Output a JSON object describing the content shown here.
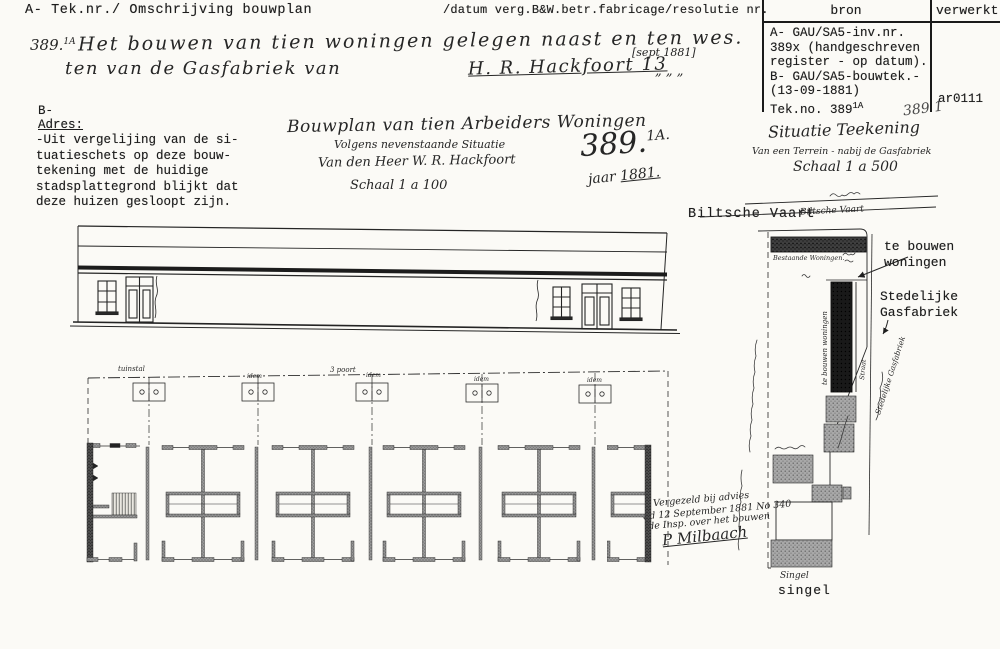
{
  "doc": {
    "header_left": "A- Tek.nr./ Omschrijving bouwplan",
    "header_center": "/datum verg.B&W.betr.fabricage/resolutie nr."
  },
  "bron_table": {
    "col_bron": "bron",
    "col_verwerkt": "verwerkt",
    "lines": [
      "A- GAU/SA5-inv.nr.",
      "389x (handgeschreven",
      "register - op datum).",
      "B- GAU/SA5-bouwtek.-",
      "(13-09-1881)"
    ],
    "tek_no": "Tek.no. 389",
    "tek_no_sup": "1A",
    "verwerkt_value": "ar0111",
    "pencil_note": "389 1"
  },
  "registration": {
    "number": "389.",
    "number_sup": "1A",
    "line1": "Het bouwen van tien woningen gelegen naast en ten wes.",
    "line2": "ten van de Gasfabriek van",
    "signature": "H. R. Hackfoort 13",
    "date_bracket": "[sept 1881]",
    "ditto_marks": "„    „    „"
  },
  "adres": {
    "b_label": "B-",
    "title": "Adres:",
    "lines": [
      "-Uit vergelijing van de si-",
      "tuatieschets op deze bouw-",
      "tekening met de huidige",
      "stadsplattegrond blijkt dat",
      "deze huizen gesloopt zijn."
    ]
  },
  "title_block": {
    "line1": "Bouwplan van tien Arbeiders Woningen",
    "line2": "Volgens nevenstaande Situatie",
    "line3": "Van den Heer W. R. Hackfoort",
    "line4": "Schaal 1 a 100",
    "number": "389.",
    "number_sup": "1A.",
    "year_label": "jaar",
    "year": "1881."
  },
  "situatie": {
    "line1": "Situatie Teekening",
    "line2": "Van een Terrein - nabij de Gasfabriek",
    "line3": "Schaal 1 a 500"
  },
  "map": {
    "canal_label": "Biltsche Vaart",
    "canal_hand": "Biltsche Vaart",
    "existing_hand": "Bestaande Woningen.",
    "new_hand_vertical": "te bouwen woningen",
    "new_callout_1": "te bouwen",
    "new_callout_2": "woningen",
    "gas_callout_1": "Stedelijke",
    "gas_callout_2": "Gasfabriek",
    "gas_hand_vertical": "Stedelijke Gasfabriek",
    "street_hand_vertical": "Straat",
    "singel_hand": "Singel",
    "singel_label": "singel"
  },
  "approval": {
    "line1": "Vergezeld bij advies",
    "line2": "dd 12 September 1881 No 340",
    "line3": "de Insp. over het bouwen",
    "signature": "P Milbaach"
  },
  "plan": {
    "label1": "tuinstal",
    "label2": "idem",
    "label3": "3 poort",
    "label4": "idem",
    "label5": "idem",
    "label6": "idem"
  }
}
